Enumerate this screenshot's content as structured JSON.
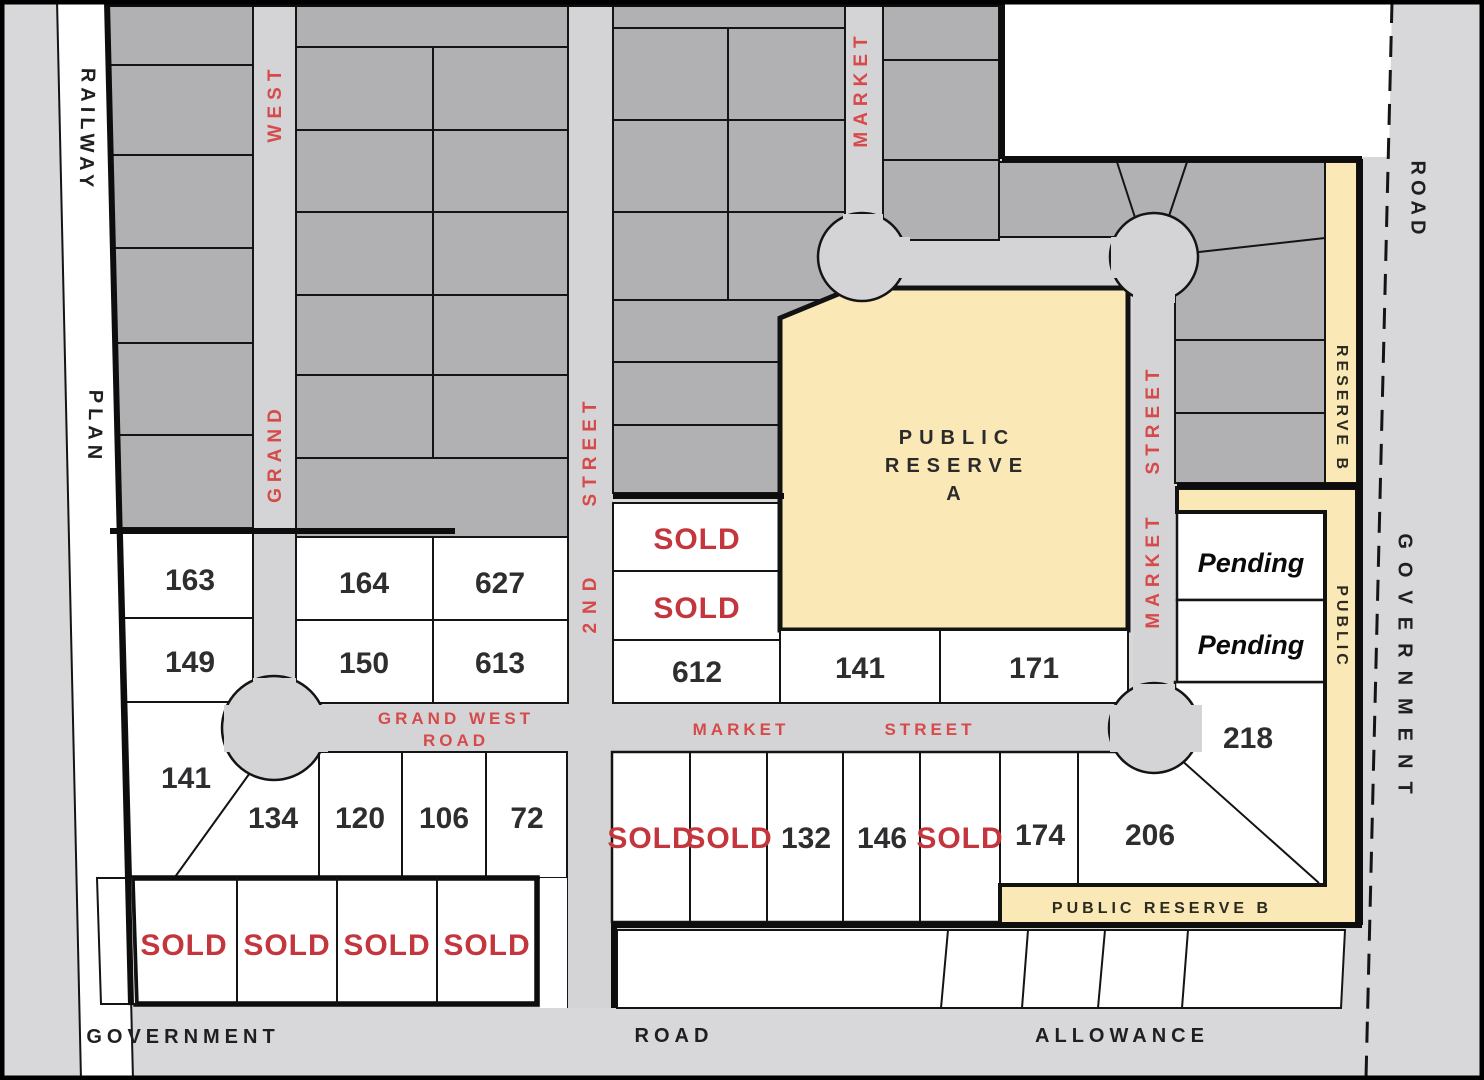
{
  "colors": {
    "background": "#d8d8da",
    "road": "#d4d4d6",
    "lot_gray": "#b1b1b3",
    "reserve_yellow": "#fbe8b7",
    "sold_red": "#c4363d",
    "street_red": "#d64a4a",
    "line_black": "#141414",
    "number_dark": "#2e2e30"
  },
  "streets": {
    "grand_west_vertical_top": "WEST",
    "grand_west_vertical_bottom": "GRAND",
    "second_street_top": "STREET",
    "second_street_bottom": "2ND",
    "market_north": "MARKET",
    "market_east_top": "STREET",
    "market_east_bottom": "MARKET",
    "grand_west_road_line1": "GRAND WEST",
    "grand_west_road_line2": "ROAD",
    "market_street_h_word1": "MARKET",
    "market_street_h_word2": "STREET"
  },
  "boundaries": {
    "railway": "RAILWAY",
    "plan": "PLAN",
    "road_ne": "ROAD",
    "government_e": "GOVERNMENT",
    "government_s": "GOVERNMENT",
    "road_s": "ROAD",
    "allowance_s": "ALLOWANCE"
  },
  "reserves": {
    "a_line1": "PUBLIC",
    "a_line2": "RESERVE",
    "a_line3": "A",
    "b_ne": "RESERVE B",
    "b_public_side": "PUBLIC",
    "b_bottom": "PUBLIC RESERVE B"
  },
  "lots": {
    "west_block": [
      "163",
      "149",
      "141",
      "134",
      "120",
      "106",
      "72"
    ],
    "grand_block": [
      "164",
      "627",
      "150",
      "613"
    ],
    "second_block": [
      "SOLD",
      "SOLD",
      "612"
    ],
    "market_row": [
      "141",
      "171"
    ],
    "south_block": [
      "SOLD",
      "SOLD",
      "132",
      "146",
      "SOLD",
      "174",
      "206",
      "218"
    ],
    "east_block": [
      "Pending",
      "Pending"
    ],
    "government_block": [
      "SOLD",
      "SOLD",
      "SOLD",
      "SOLD"
    ]
  }
}
